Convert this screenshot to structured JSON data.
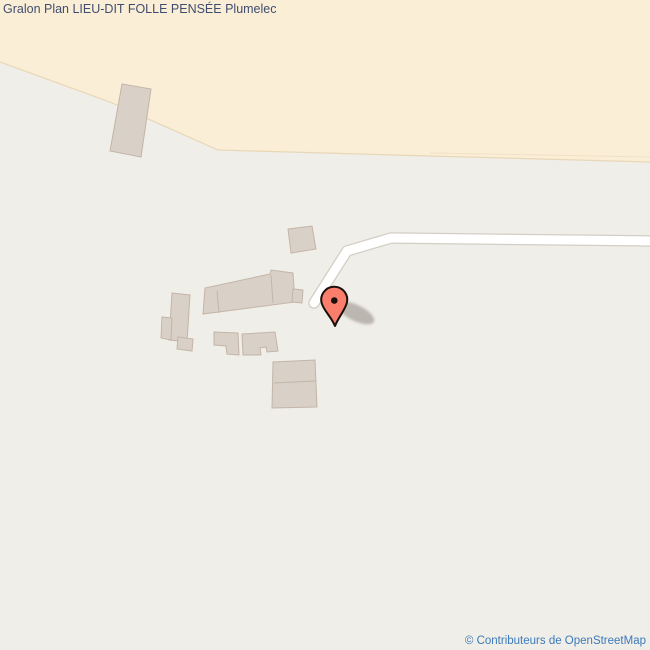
{
  "page": {
    "title": "Gralon Plan LIEU-DIT FOLLE PENSÉE Plumelec",
    "attribution": "© Contributeurs de OpenStreetMap"
  },
  "icons": {
    "marker": "location-pin-icon"
  },
  "colors": {
    "map-bg": "#f0eee9",
    "farmland": "#fbeed7",
    "farmland-edge": "#e8d7b7",
    "building-fill": "#d9d0c8",
    "building-stroke": "#c3b5a7",
    "road-fill": "#ffffff",
    "road-casing": "#d2cec5",
    "marker-fill": "#fb7d6b",
    "marker-outline": "#1b100b",
    "title-color": "#3f4e6e",
    "link-color": "#3b7ab8"
  }
}
